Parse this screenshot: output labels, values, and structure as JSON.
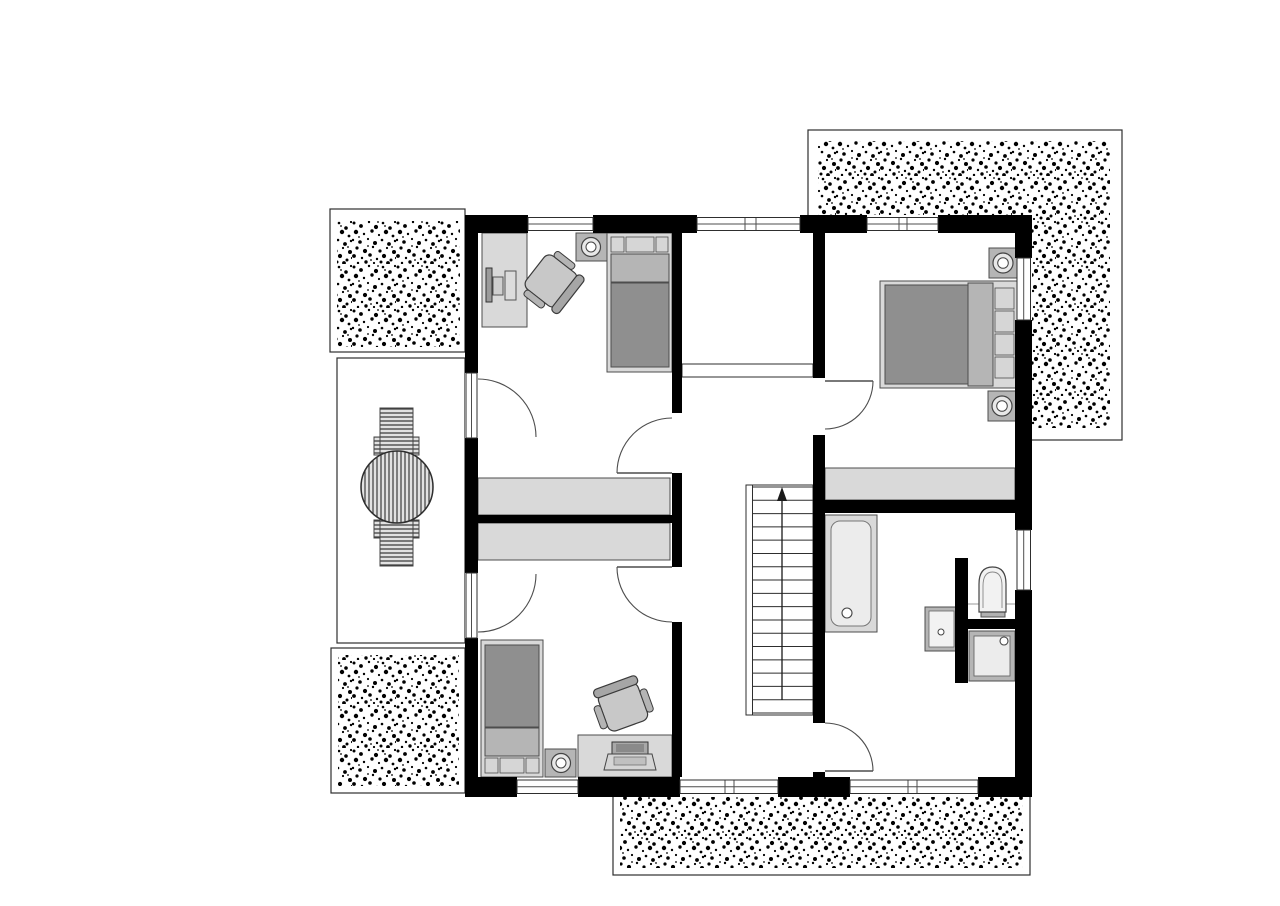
{
  "canvas": {
    "width": 1280,
    "height": 906,
    "background": "#ffffff"
  },
  "palette": {
    "paper": "#ffffff",
    "wall": "#000000",
    "line": "#2e2e2e",
    "line_soft": "#4d4d4d",
    "furniture_light": "#d9d9d9",
    "furniture_mid": "#b5b5b5",
    "furniture_dark": "#8f8f8f",
    "fixture_fill": "#ececec",
    "stipple_dot": "#000000"
  },
  "plan": {
    "type": "residential-upper-floor-plan",
    "rooms": [
      {
        "name": "bedroom-top-left",
        "furniture": [
          "desk",
          "monitor",
          "office-chair",
          "nightstand-with-lamp",
          "single-bed",
          "built-in-wardrobe",
          "balcony-door"
        ]
      },
      {
        "name": "bedroom-bottom-left",
        "furniture": [
          "single-bed",
          "nightstand-with-lamp",
          "desk",
          "laptop",
          "office-chair",
          "built-in-wardrobe",
          "balcony-door"
        ]
      },
      {
        "name": "master-bedroom",
        "furniture": [
          "double-bed",
          "nightstand-with-lamp",
          "nightstand-with-lamp",
          "knee-wall-storage"
        ]
      },
      {
        "name": "bathroom",
        "fixtures": [
          "bathtub",
          "washbasin",
          "toilet",
          "shower"
        ]
      },
      {
        "name": "hallway-landing",
        "features": [
          "staircase-up",
          "gallery-railing",
          "open-void"
        ]
      }
    ],
    "outdoor_areas": [
      {
        "name": "balcony",
        "furniture": [
          "sun-lounger",
          "sun-lounger",
          "round-parasol"
        ]
      },
      {
        "name": "roof-terrace-top-right",
        "texture": "stipple"
      },
      {
        "name": "roof-area-top-left",
        "texture": "stipple"
      },
      {
        "name": "roof-area-bottom-left",
        "texture": "stipple"
      },
      {
        "name": "roof-area-bottom",
        "texture": "stipple"
      }
    ],
    "stairs": {
      "treads": 17,
      "x1": 752.5,
      "x2": 813,
      "y_top": 487,
      "y_bottom": 713,
      "arrow_x": 782,
      "direction": "up"
    }
  }
}
